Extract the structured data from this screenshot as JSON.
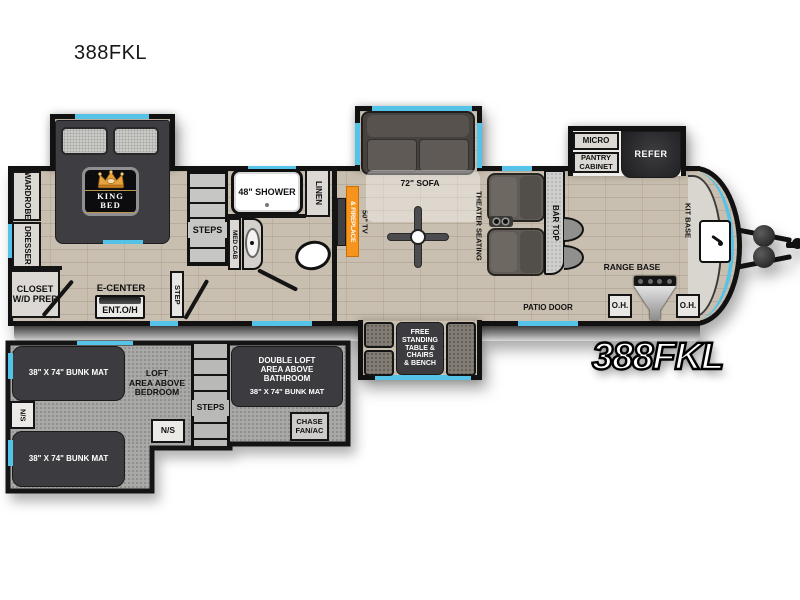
{
  "title": "388FKL",
  "model_badge": "388FKL",
  "colors": {
    "accent_window_blue": "#55c2e8",
    "fireplace_orange": "#f7941d",
    "floor_tan": "#c9bfb0",
    "loft_gray": "#a9a9a7",
    "furniture_dark": "#3c3c40",
    "wall_black": "#141414"
  },
  "bedroom": {
    "wardrobe": "WARDROBE",
    "dresser": "DRESSER",
    "closet": "CLOSET\nW/D PREP",
    "king_bed": "KING BED",
    "e_center": "E-CENTER",
    "ent_oh": "ENT.O/H",
    "step": "STEP",
    "steps": "STEPS"
  },
  "bathroom": {
    "shower": "48\" SHOWER",
    "linen": "LINEN",
    "med_cab": "MED CAB"
  },
  "living": {
    "tv": "50\" TV",
    "fireplace": "& FIREPLACE",
    "sofa": "72\" SOFA",
    "theater": "THEATER SEATING",
    "bar_top": "BAR TOP",
    "patio_door": "PATIO DOOR",
    "dinette": "FREE\nSTANDING\nTABLE &\nCHAIRS\n& BENCH"
  },
  "kitchen": {
    "micro": "MICRO",
    "pantry": "PANTRY\nCABINET",
    "refer": "REFER",
    "kit_base": "KIT BASE",
    "range_base": "RANGE BASE",
    "oh_left": "O.H.",
    "oh_right": "O.H."
  },
  "loft": {
    "bunk_top": "38\" X 74\" BUNK MAT",
    "bunk_bottom": "38\" X 74\" BUNK MAT",
    "ns_left": "N/S",
    "ns_mid": "N/S",
    "steps": "STEPS",
    "area_bedroom": "LOFT\nAREA ABOVE\nBEDROOM",
    "double_loft": "DOUBLE LOFT\nAREA ABOVE\nBATHROOM",
    "double_bunk": "38\" X 74\" BUNK MAT",
    "chase": "CHASE\nFAN/AC"
  }
}
